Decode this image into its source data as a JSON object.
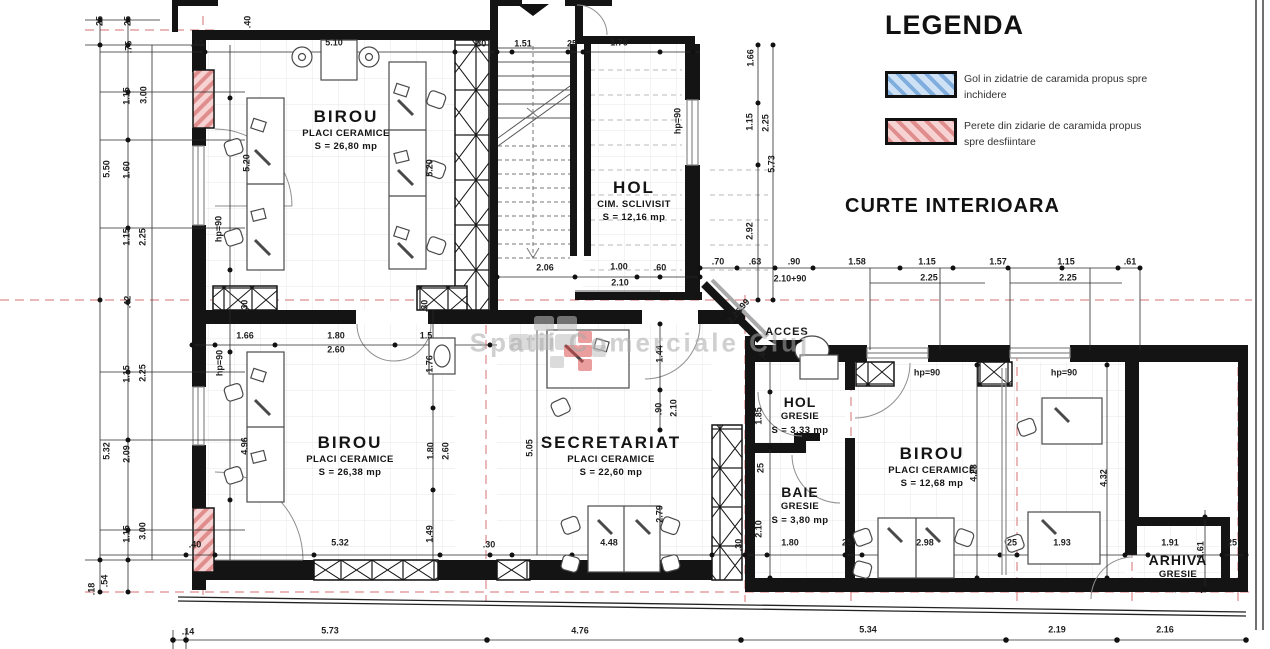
{
  "legend": {
    "title": "LEGENDA",
    "items": [
      {
        "label": "Gol in zidatrie de caramida propus spre inchidere",
        "hatch_color": "#9fc3e8"
      },
      {
        "label": "Perete din zidarie de caramida propus spre desfiintare",
        "hatch_color": "#efa5a5"
      }
    ]
  },
  "labels": {
    "courtyard": "CURTE INTERIOARA",
    "acces": "ACCES",
    "watermark": "Spatii Comerciale Cluj"
  },
  "rooms": {
    "birou1": {
      "name": "BIROU",
      "finish": "PLACI CERAMICE",
      "area": "S = 26,80 mp"
    },
    "hol1": {
      "name": "HOL",
      "finish": "CIM. SCLIVISIT",
      "area": "S = 12,16 mp"
    },
    "birou2": {
      "name": "BIROU",
      "finish": "PLACI CERAMICE",
      "area": "S = 26,38 mp"
    },
    "secretariat": {
      "name": "SECRETARIAT",
      "finish": "PLACI CERAMICE",
      "area": "S = 22,60 mp"
    },
    "hol2": {
      "name": "HOL",
      "finish": "GRESIE",
      "area": "S = 3,33 mp"
    },
    "baie": {
      "name": "BAIE",
      "finish": "GRESIE",
      "area": "S = 3,80 mp"
    },
    "birou3": {
      "name": "BIROU",
      "finish": "PLACI CERAMICE",
      "area": "S = 12,68 mp"
    },
    "arhiva": {
      "name": "ARHIVA",
      "finish": "GRESIE",
      "area": "S = 3,05 mp"
    }
  },
  "dims": {
    "left": [
      "25",
      "25",
      ".75",
      "1.15",
      "3.00",
      "1.60",
      "5.50",
      "1.15",
      "2.25",
      ".42",
      "1.15",
      "2.25",
      "5.32",
      "2.09",
      "1.15",
      "3.00",
      ".54",
      ".18"
    ],
    "top": [
      ".40",
      ".40",
      "5.10",
      ".30",
      "1.51",
      "25",
      "1.76"
    ],
    "hol_right": [
      "1.66",
      "1.15",
      "2.25",
      "5.73",
      "2.92",
      "hp=90"
    ],
    "mid": [
      "2.06",
      "1.00",
      ".60",
      "2.10",
      ".70",
      ".63",
      ".90",
      "2.10+90",
      "1.58",
      "1.15",
      "2.25",
      "1.57",
      "1.15",
      "2.25",
      ".61"
    ],
    "acces": [
      ".99",
      "2.25",
      ".40"
    ],
    "piers": [
      ".30",
      ".30"
    ],
    "room1": [
      "5.20",
      "5.20",
      "hp=90"
    ],
    "room2": [
      "hp=90",
      "1.66",
      "1.80",
      "2.60",
      "1.5",
      "1.76",
      "4.96",
      "1.80",
      "2.60",
      "1.49",
      ".40",
      "5.32",
      ".30"
    ],
    "secretariat": [
      "5.05",
      "1.44",
      ".90",
      "2.10",
      "2.79",
      "4.48",
      ".30"
    ],
    "wing": [
      "1.85",
      "25",
      "2.10",
      "1.80",
      "25",
      "hp=90",
      "hp=90",
      "4.28",
      "4.32",
      "2.98",
      "1.93",
      "25",
      "1.91",
      "1.61",
      "25"
    ],
    "bottom": [
      ".14",
      "5.73",
      "4.76",
      "5.34",
      "2.19",
      "2.16"
    ]
  },
  "colors": {
    "wall": "#141414",
    "axis_red": "#d47272",
    "hatch_red": "#efa5a5",
    "hatch_blue": "#9fc3e8",
    "window_gray": "#8a8a8a",
    "furniture": "#4a4a4a",
    "watermark_gray": "#aaaaaa",
    "logo_red": "#d94f4f"
  }
}
